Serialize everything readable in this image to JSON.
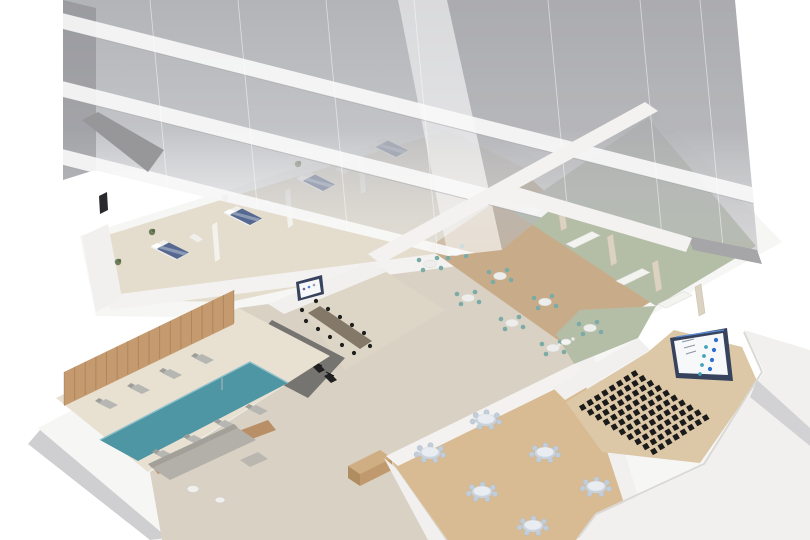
{
  "scene": {
    "title": "building-cutaway-render",
    "description": "Isometric 3D cutaway of a glass high-rise tower revealing an amenity floor with guest rooms, pool, gym, meeting room, restaurant, lounges, banquet hall and auditorium",
    "background": "#ffffff"
  },
  "colors": {
    "podium": "#f6f6f5",
    "podium_face_left": "#cfcfd1",
    "podium_face_right": "#d2d2d4",
    "lower_floor": "#d9d1c3",
    "wing_floor": "#e4dccc",
    "parapet": "#f3f2f0",
    "wall_white": "#f1f0ee",
    "roof_slab_dark": "#97979a",
    "conference_floor": "#ddd6c6",
    "conference_table": "#847868",
    "gym_floor": "#767470",
    "pool_deck": "#e8e0d1",
    "pool_water": "#4f96a5",
    "wood_wall": "#c49a6e",
    "wood_wall_dark": "#b88f66",
    "sofa_gray": "#b3b0a9",
    "console_wood": "#cfae83",
    "banquet_carpet": "#d8bb92",
    "restaurant_wood": "#c8ac89",
    "green_floor": "#b4bea7",
    "auditorium_floor": "#dcc7a6",
    "seat_black": "#1b1b1b",
    "screen_bezel": "#37425c",
    "screen_face": "#f6f8fa",
    "bed_navy": "#56688f",
    "chair_teal": "#7aaba7",
    "banquet_chair": "#c2cdda",
    "tower_foot": "#a6a6a9"
  },
  "tower": {
    "floors_visible": 4,
    "band_tops_left": [
      13,
      81,
      149
    ],
    "mullions_x": [
      150,
      238,
      326,
      414,
      548,
      640,
      700
    ]
  },
  "rooms": [
    {
      "name": "guest-room-wing",
      "floor": "#e4dccc",
      "items": "4 beds, plants, desks"
    },
    {
      "name": "conference-room",
      "floor": "#ddd6c6",
      "items": "long table, 12 chairs, wall screen"
    },
    {
      "name": "gym",
      "floor": "#767470",
      "items": "6 machines"
    },
    {
      "name": "pool-area",
      "floor": "#e8e0d1",
      "items": "pool, 8 loungers, wood slat wall"
    },
    {
      "name": "lounge",
      "floor": "#d9d1c3",
      "items": "sectional sofa, 2 coffee tables"
    },
    {
      "name": "banquet-hall",
      "floor": "#d8bb92",
      "items": "6 round tables"
    },
    {
      "name": "restaurant",
      "floor": "#c8ac89",
      "items": "8 tables with teal chairs"
    },
    {
      "name": "green-lounge",
      "floor": "#b4bea7",
      "items": "4 white sofas, privacy partitions"
    },
    {
      "name": "auditorium",
      "floor": "#dcc7a6",
      "items": "80 seats, presentation screen"
    }
  ],
  "furniture": {
    "beds": [
      [
        170,
        250
      ],
      [
        243,
        216
      ],
      [
        316,
        182
      ],
      [
        389,
        148
      ]
    ],
    "plants": [
      [
        152,
        232
      ],
      [
        225,
        198
      ],
      [
        298,
        164
      ],
      [
        118,
        262
      ],
      [
        233,
        344
      ]
    ],
    "desks": [
      [
        196,
        238
      ],
      [
        269,
        204
      ],
      [
        342,
        170
      ]
    ],
    "wing_partitions": [
      [
        214,
        243
      ],
      [
        287,
        209
      ],
      [
        360,
        175
      ]
    ],
    "conference_chairs": [
      [
        316,
        301
      ],
      [
        328,
        309
      ],
      [
        340,
        317
      ],
      [
        352,
        325
      ],
      [
        364,
        333
      ],
      [
        306,
        321
      ],
      [
        318,
        329
      ],
      [
        330,
        337
      ],
      [
        342,
        345
      ],
      [
        354,
        353
      ],
      [
        302,
        310
      ],
      [
        370,
        346
      ]
    ],
    "conference_screen_marks": [
      [
        304,
        289,
        "#7a5f9e"
      ],
      [
        309,
        287,
        "#4a7fd4"
      ],
      [
        314,
        285,
        "#9aa0a8"
      ]
    ],
    "gym_equipment": [
      [
        272,
        348
      ],
      [
        290,
        358
      ],
      [
        306,
        350
      ],
      [
        318,
        368
      ],
      [
        330,
        378
      ],
      [
        276,
        370
      ]
    ],
    "loungers_north": [
      [
        108,
        404
      ],
      [
        140,
        389
      ],
      [
        172,
        374
      ],
      [
        204,
        359
      ]
    ],
    "loungers_south": [
      [
        165,
        455
      ],
      [
        196,
        440
      ],
      [
        227,
        425
      ],
      [
        258,
        410
      ]
    ],
    "lounge_tables": [
      [
        193,
        489
      ],
      [
        220,
        500
      ]
    ],
    "restaurant_tables": [
      [
        455,
        252
      ],
      [
        430,
        264
      ],
      [
        500,
        276
      ],
      [
        468,
        298
      ],
      [
        545,
        302
      ],
      [
        512,
        323
      ],
      [
        590,
        328
      ],
      [
        553,
        348
      ]
    ],
    "green_sofas": [
      [
        540,
        207
      ],
      [
        583,
        240
      ],
      [
        633,
        277
      ],
      [
        675,
        300
      ]
    ],
    "green_partitions": [
      [
        560,
        215
      ],
      [
        610,
        250
      ],
      [
        655,
        276
      ],
      [
        698,
        300
      ]
    ],
    "green_minitable": [
      566,
      342
    ],
    "banquet_tables": [
      [
        486,
        420
      ],
      [
        430,
        453
      ],
      [
        545,
        453
      ],
      [
        596,
        487
      ],
      [
        482,
        492
      ],
      [
        533,
        526
      ]
    ],
    "auditorium_seats": {
      "origin": [
        582,
        408
      ],
      "seat_step": [
        7.4,
        -4.8
      ],
      "row_step": [
        7.9,
        4.9
      ],
      "per_row": 8,
      "rows": 10
    },
    "aud_screen_dots_blue": [
      [
        716,
        340
      ],
      [
        714,
        350
      ],
      [
        712,
        360
      ],
      [
        710,
        369
      ]
    ],
    "aud_screen_dots_teal": [
      [
        706,
        347
      ],
      [
        704,
        356
      ],
      [
        702,
        365
      ],
      [
        700,
        374
      ]
    ],
    "wood_slats": {
      "count": 17,
      "x0": 64,
      "x1": 234,
      "ytop0": 372,
      "ytop1": 290,
      "len": 33
    }
  }
}
